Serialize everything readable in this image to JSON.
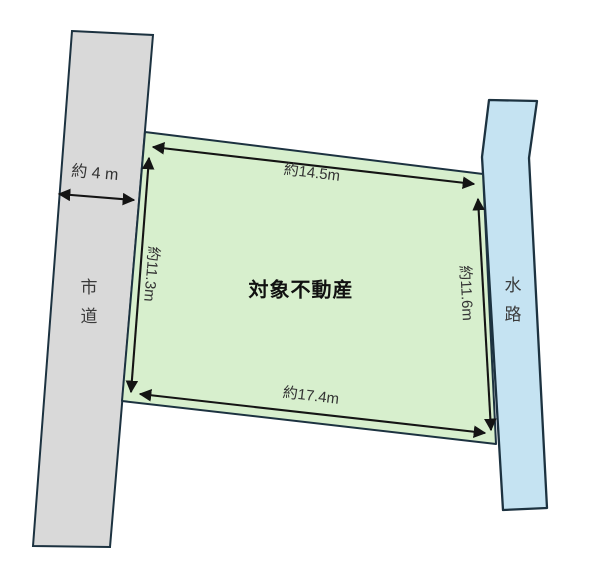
{
  "colors": {
    "background": "#ffffff",
    "road_fill": "#d9d9d9",
    "water_fill": "#c5e3f2",
    "parcel_fill": "#d7efcd",
    "shape_outline": "#1c3240",
    "arrow": "#141414",
    "dimension_text": "#333333",
    "area_text": "#3b3b3b",
    "parcel_text": "#111111"
  },
  "diagram": {
    "parcel": {
      "label": "対象不動産"
    },
    "road": {
      "label": "市道"
    },
    "waterway": {
      "label": "水路"
    },
    "dimensions": {
      "top": "約14.5m",
      "left": "約11.3m",
      "right": "約11.6m",
      "bottom": "約17.4m",
      "road_width": "約 4 m"
    }
  }
}
